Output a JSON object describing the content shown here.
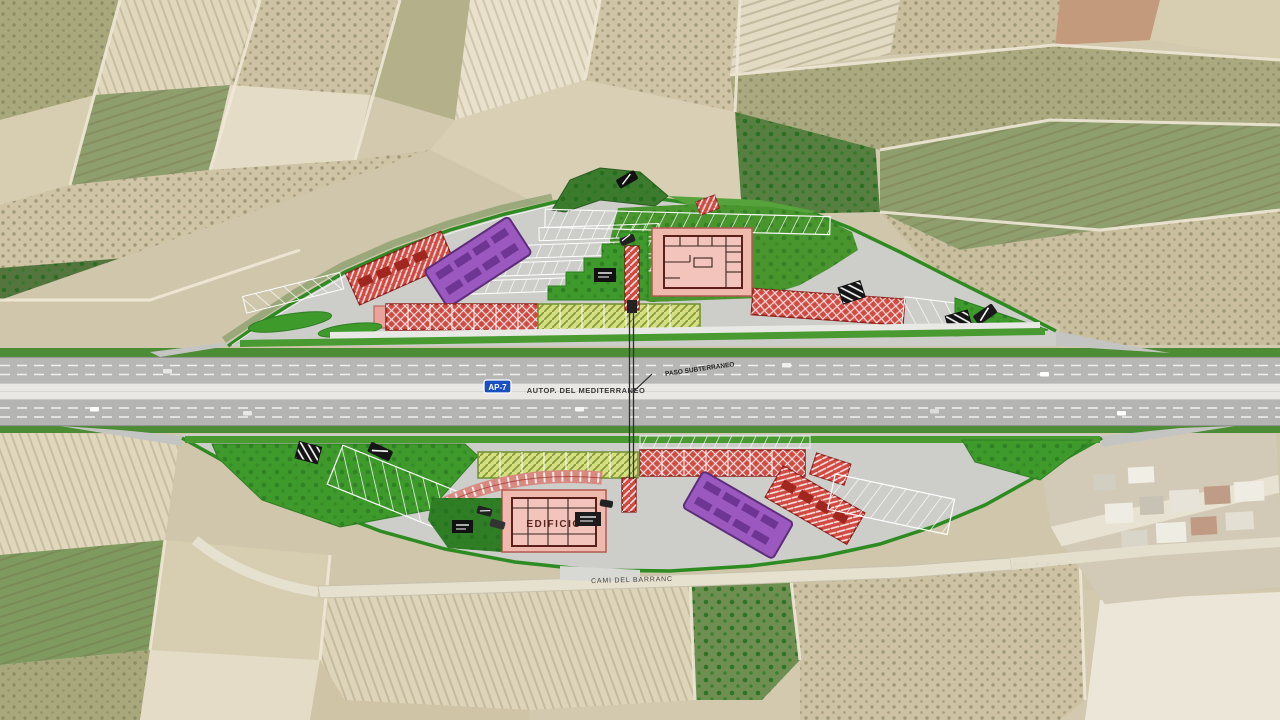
{
  "map": {
    "description": "Aerial orthophoto with overlaid engineering plan of a motorway service / rest area on both sides of the AP-7",
    "labels": {
      "motorway_badge": "AP-7",
      "motorway_name": "AUTOP. DEL MEDITERRANEO",
      "underpass": "PASO SUBTERRANEO",
      "south_road": "CAMI DEL BARRANC",
      "south_building": "EDIFICIO"
    },
    "legend_colors": {
      "truck_parking_red": "#d14b43",
      "bus_parking_purple": "#9b59c0",
      "car_parking_yellow_green": "#d6df80",
      "landscaped_green": "#3f9a2c",
      "building_pink": "#f0b9ae",
      "badge_blue": "#1a4fbf",
      "boundary_green": "#2e8b22"
    }
  }
}
